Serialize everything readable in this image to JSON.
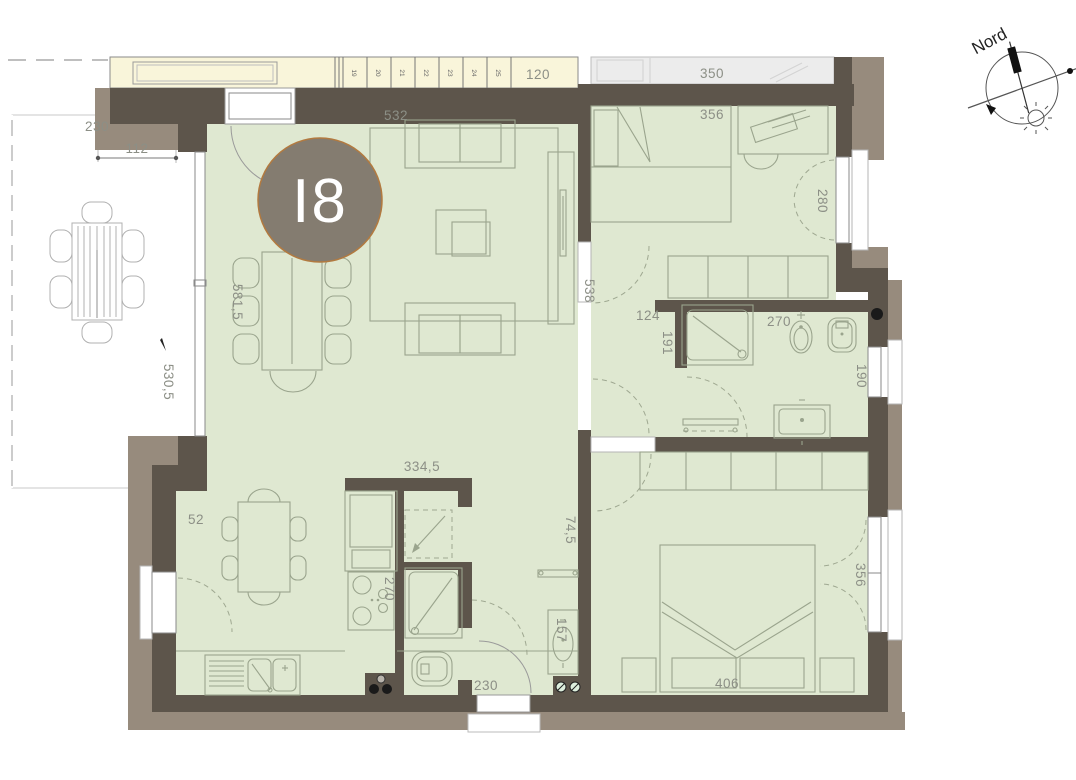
{
  "unit_badge": {
    "label": "I8"
  },
  "compass": {
    "label": "Nord"
  },
  "corridor": {
    "stair_steps": [
      "19",
      "20",
      "21",
      "22",
      "23",
      "24",
      "25"
    ],
    "width_label": "120"
  },
  "neighbor_unit": {
    "area_label": "350"
  },
  "dims": {
    "terrace_width": "230",
    "terrace_offset": "112",
    "terrace_length": "530,5",
    "living_width": "532",
    "living_length": "581,5",
    "living_wall": "538",
    "bedroom1_width": "356",
    "bedroom1_window": "280",
    "hall_bath": "124",
    "bath_length": "191",
    "bath_width": "270",
    "bath_window": "190",
    "kitchen_wall": "334,5",
    "kitchen_niche": "52",
    "kitchen_depth": "270",
    "hall_width": "74,5",
    "hall_sink": "157",
    "entrance_door": "230",
    "bedroom2_width": "406",
    "bedroom2_window": "356"
  },
  "colors": {
    "floor": "#dfe8d1",
    "corridor": "#f9f5da",
    "neighbor": "#ececec",
    "wall_dark": "#5d554b",
    "wall_light": "#978b7d",
    "line": "#9aa48d",
    "line_terrace": "#b0b0b0",
    "dim_text": "#8c8f86",
    "badge_fill": "#847c70",
    "badge_ring": "#b27a40",
    "badge_text": "#ffffff",
    "symbol_black": "#1a1a1a"
  }
}
